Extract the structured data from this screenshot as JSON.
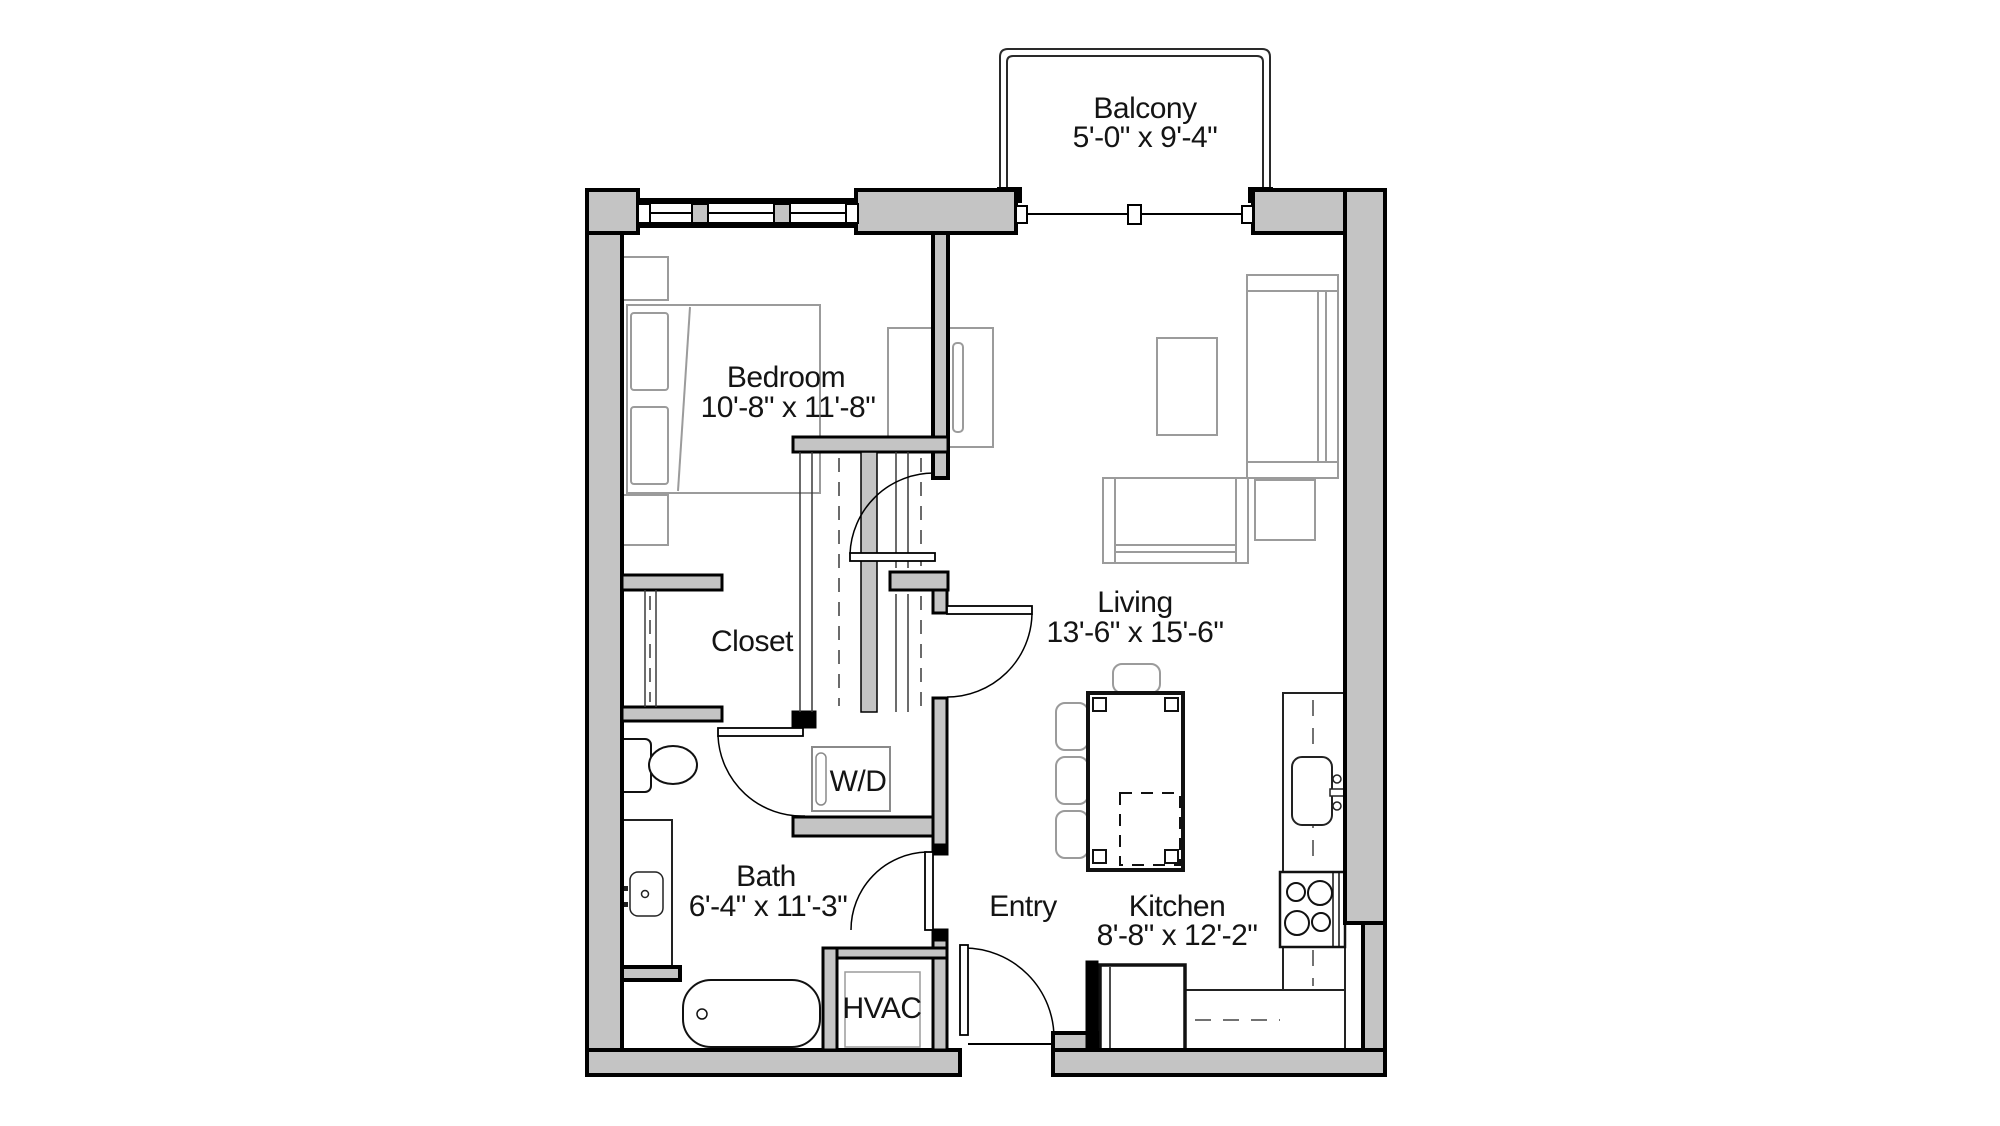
{
  "plan": {
    "type": "apartment-floor-plan",
    "rooms": {
      "balcony": {
        "name": "Balcony",
        "dimensions": "5'-0\" x 9'-4\""
      },
      "bedroom": {
        "name": "Bedroom",
        "dimensions": "10'-8\" x 11'-8\""
      },
      "living": {
        "name": "Living",
        "dimensions": "13'-6\" x 15'-6\""
      },
      "closet": {
        "name": "Closet"
      },
      "laundry": {
        "name": "W/D"
      },
      "bath": {
        "name": "Bath",
        "dimensions": "6'-4\" x 11'-3\""
      },
      "hvac": {
        "name": "HVAC"
      },
      "entry": {
        "name": "Entry"
      },
      "kitchen": {
        "name": "Kitchen",
        "dimensions": "8'-8\" x 12'-2\""
      }
    },
    "colors": {
      "wall_fill": "#c4c4c4",
      "wall_outline": "#000000",
      "furniture_line": "#9b9b9b",
      "fixture_line": "#1a1a1a",
      "background": "#ffffff",
      "text": "#141414"
    }
  }
}
